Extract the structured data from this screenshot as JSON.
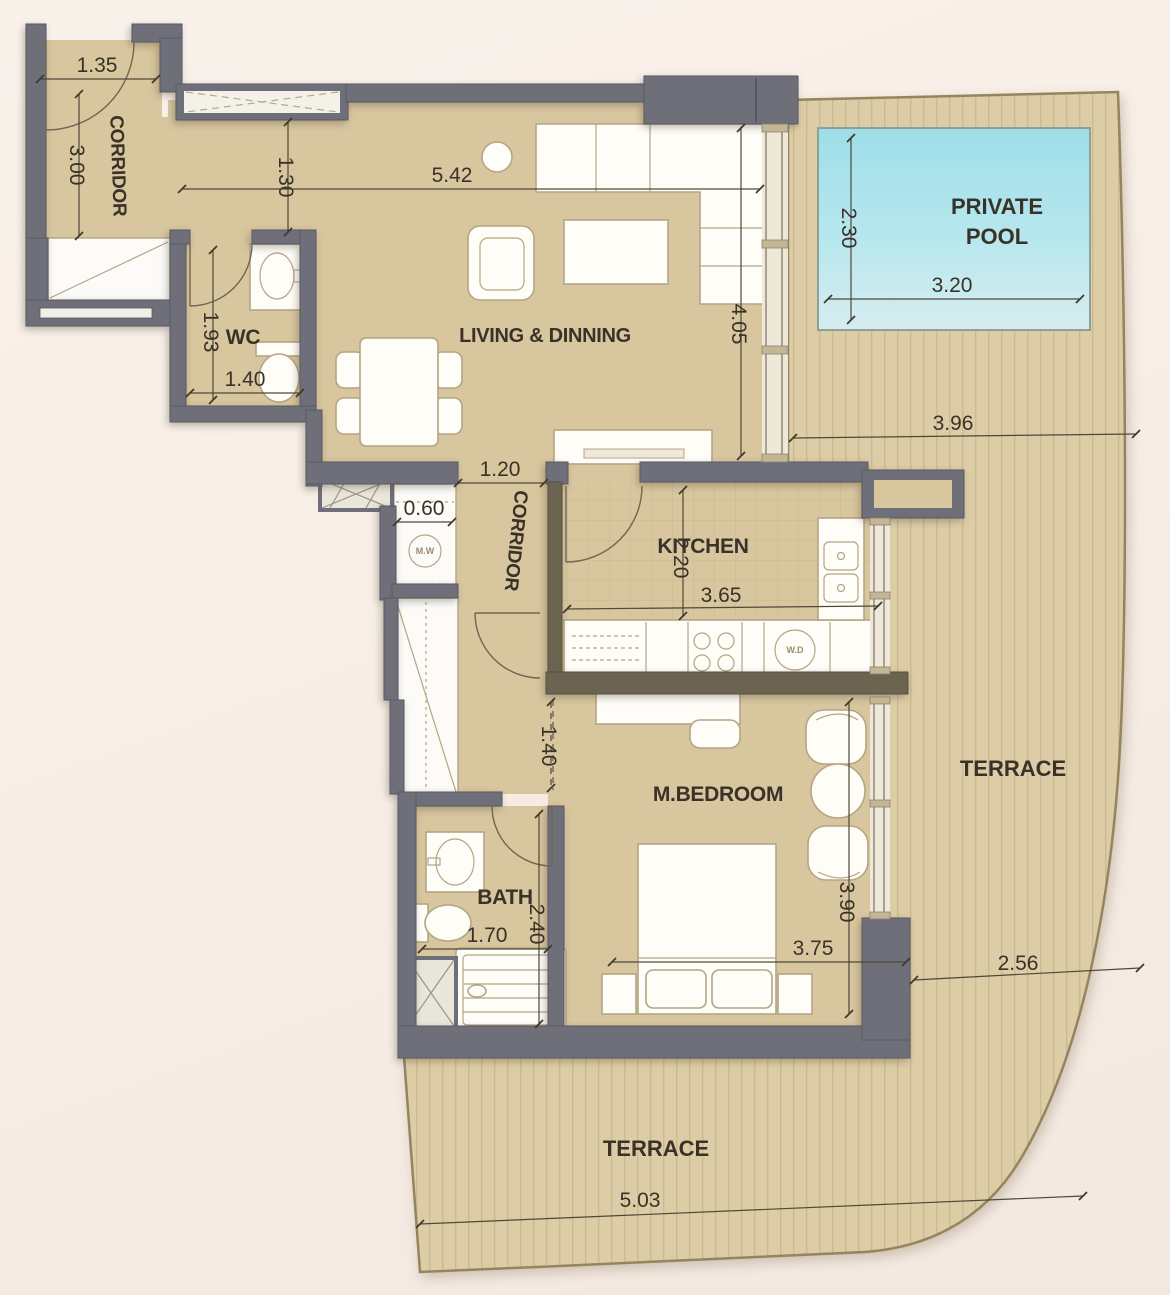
{
  "labels": {
    "corridor_upper": "CORRIDOR",
    "corridor_inner": "CORRIDOR",
    "wc": "WC",
    "living_dining": "LIVING & DINNING",
    "private_pool_line1": "PRIVATE",
    "private_pool_line2": "POOL",
    "kitchen": "KITCHEN",
    "master_bedroom": "M.BEDROOM",
    "bath": "BATH",
    "terrace_right": "TERRACE",
    "terrace_bottom": "TERRACE",
    "microwave": "M.W",
    "washer_dryer": "W.D"
  },
  "dimensions": {
    "corridor_width": "1.35",
    "corridor_length": "3.00",
    "entry_passage": "1.30",
    "living_width": "5.42",
    "living_depth": "4.05",
    "pool_depth": "2.30",
    "pool_width": "3.20",
    "terrace_top_width": "3.96",
    "wc_length": "1.93",
    "wc_width": "1.40",
    "hall_opening": "1.20",
    "closet_depth": "0.60",
    "kitchen_depth": "2.20",
    "kitchen_width": "3.65",
    "hallway_width": "1.40",
    "bedroom_depth": "3.90",
    "bedroom_width": "3.75",
    "bath_length": "2.40",
    "bath_width": "1.70",
    "terrace_right_width": "2.56",
    "terrace_bottom_width": "5.03"
  },
  "colors": {
    "wall": "#6f6f79",
    "partition_wall": "#6b6450",
    "floor": "#d8c69e",
    "terrace_wood": "#ddcda6",
    "terrace_stripe": "#cbb992",
    "pool_water": "#a5dfe7",
    "background": "#f7efe7",
    "text": "#3a3228"
  }
}
